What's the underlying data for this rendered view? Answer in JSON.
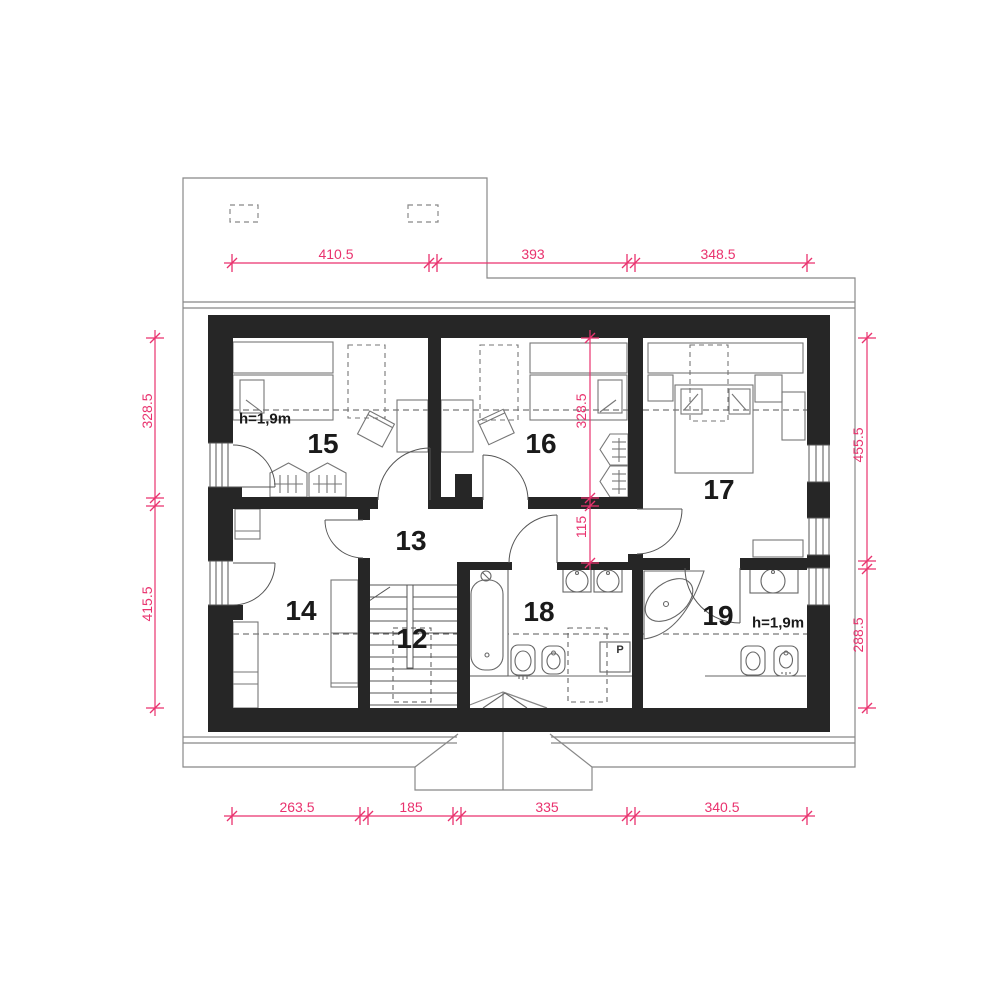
{
  "drawing": {
    "rooms": {
      "r12": "12",
      "r13": "13",
      "r14": "14",
      "r15": "15",
      "r16": "16",
      "r17": "17",
      "r18": "18",
      "r19": "19"
    },
    "annotations": {
      "height_note_room15": "h=1,9m",
      "height_note_room19": "h=1,9m",
      "washer": "P"
    },
    "dimensions": {
      "top": {
        "d1": "410.5",
        "d2": "393",
        "d3": "348.5"
      },
      "bottom": {
        "d1": "263.5",
        "d2": "185",
        "d3": "335",
        "d4": "340.5"
      },
      "left": {
        "d1": "328.5",
        "d2": "415.5"
      },
      "right": {
        "d1": "455.5",
        "d2": "288.5"
      },
      "middle": {
        "d1": "328.5",
        "d2": "115"
      }
    },
    "colors": {
      "dimension": "#e9326e",
      "wall": "#262626",
      "furniture": "#767676",
      "roof": "#888888",
      "text": "#111111"
    }
  }
}
